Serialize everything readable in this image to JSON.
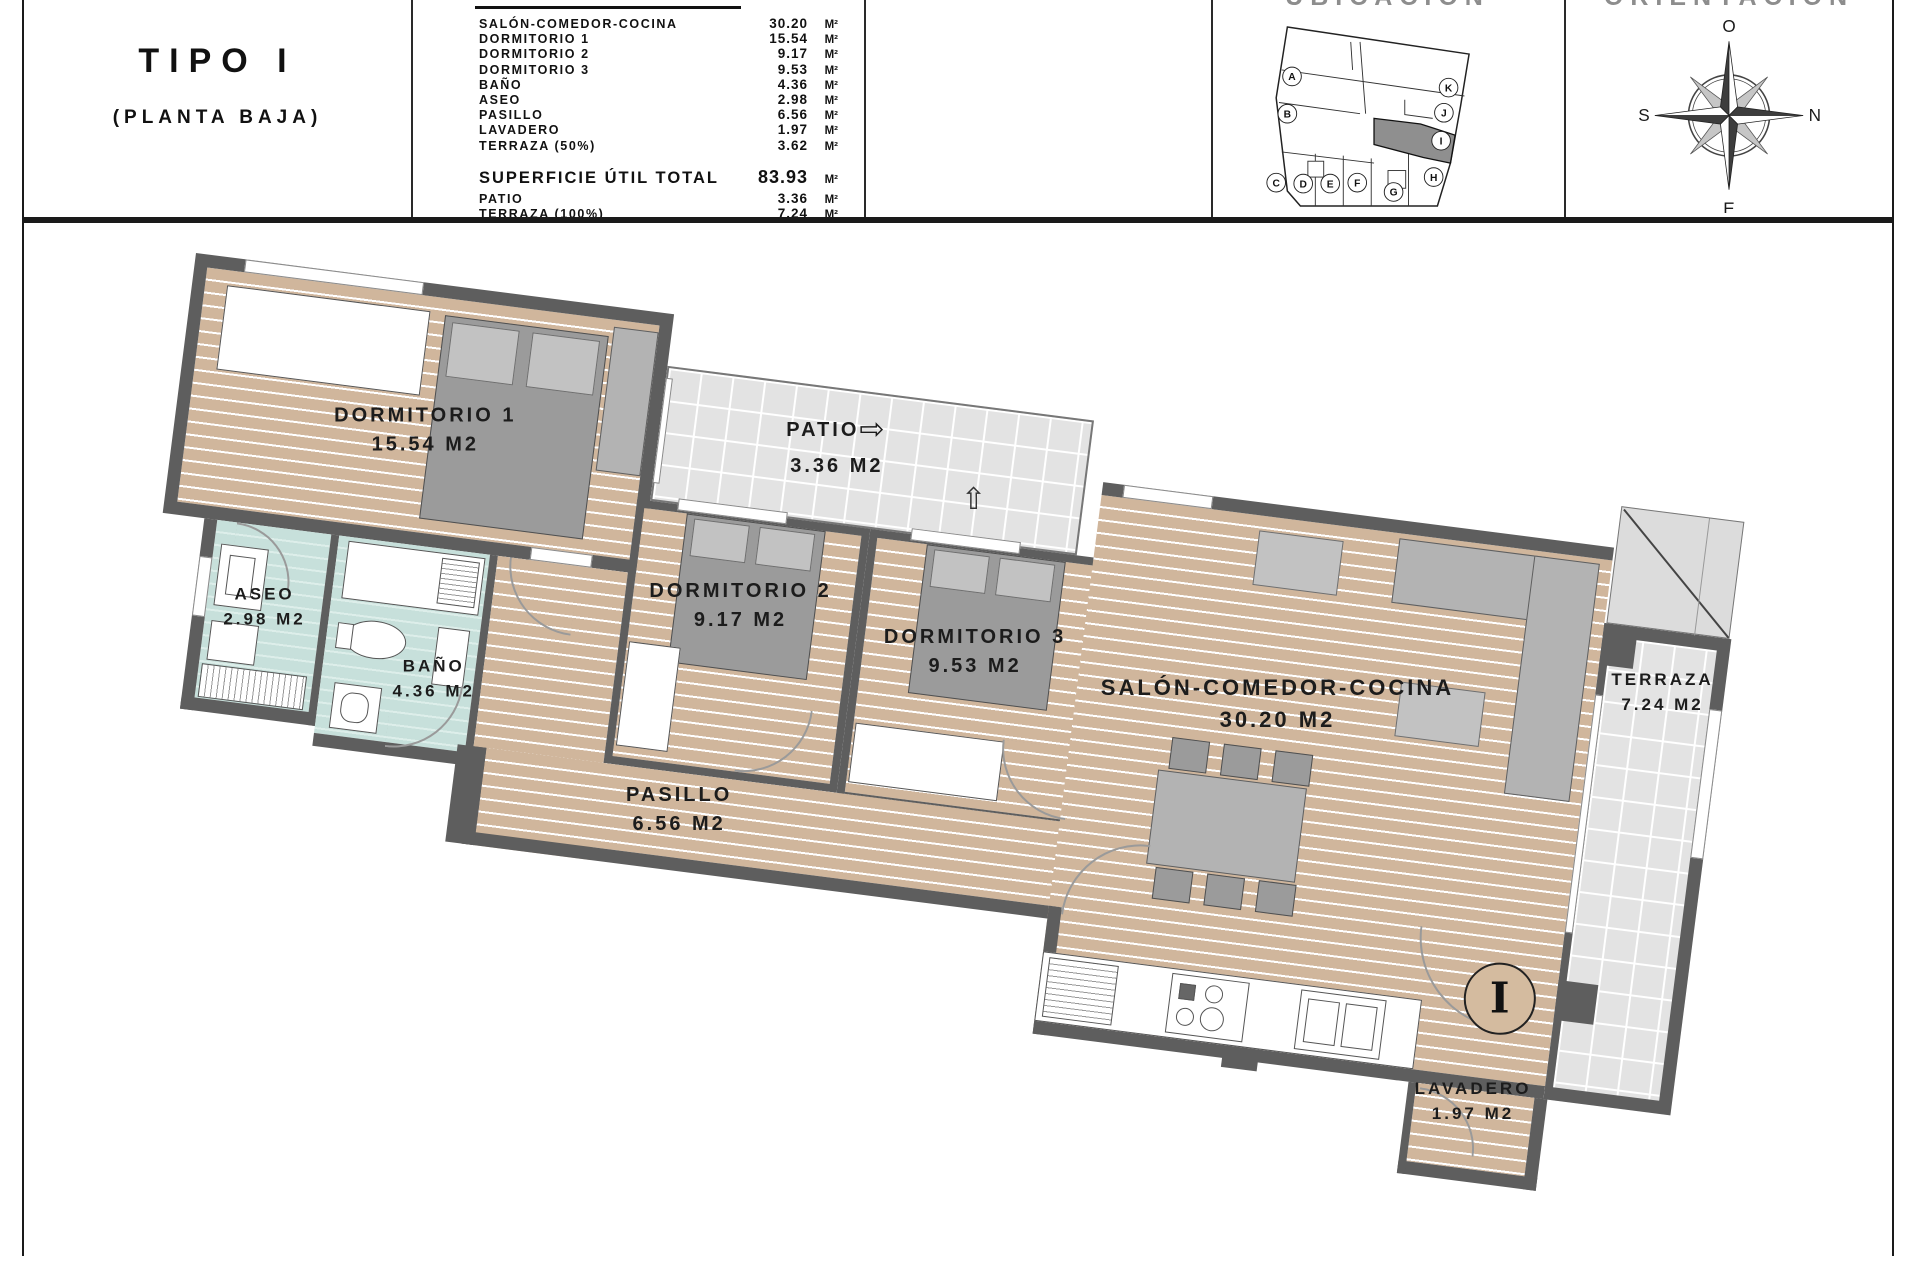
{
  "title_block": {
    "type_label": "TIPO I",
    "floor_label": "(PLANTA BAJA)"
  },
  "surface_table": {
    "unit": "M²",
    "rows": [
      {
        "label": "SALÓN-COMEDOR-COCINA",
        "value": "30.20"
      },
      {
        "label": "DORMITORIO 1",
        "value": "15.54"
      },
      {
        "label": "DORMITORIO 2",
        "value": "9.17"
      },
      {
        "label": "DORMITORIO 3",
        "value": "9.53"
      },
      {
        "label": "BAÑO",
        "value": "4.36"
      },
      {
        "label": "ASEO",
        "value": "2.98"
      },
      {
        "label": "PASILLO",
        "value": "6.56"
      },
      {
        "label": "LAVADERO",
        "value": "1.97"
      },
      {
        "label": "TERRAZA (50%)",
        "value": "3.62"
      }
    ],
    "total": {
      "label": "SUPERFICIE ÚTIL TOTAL",
      "value": "83.93"
    },
    "extra_rows": [
      {
        "label": "PATIO",
        "value": "3.36"
      },
      {
        "label": "TERRAZA (100%)",
        "value": "7.24"
      }
    ]
  },
  "location": {
    "header": "UBICACIÓN",
    "highlighted_unit": "I",
    "units": [
      "A",
      "B",
      "C",
      "D",
      "E",
      "F",
      "G",
      "H",
      "I",
      "J",
      "K"
    ]
  },
  "compass": {
    "header": "ORIENTACIÓN",
    "top": "O",
    "right": "N",
    "bottom": "E",
    "left": "S"
  },
  "plan": {
    "rooms": [
      {
        "name": "DORMITORIO 1",
        "area": "15.54 M2"
      },
      {
        "name": "PATIO",
        "area": "3.36 M2"
      },
      {
        "name": "ASEO",
        "area": "2.98 M2"
      },
      {
        "name": "BAÑO",
        "area": "4.36 M2"
      },
      {
        "name": "DORMITORIO 2",
        "area": "9.17 M2"
      },
      {
        "name": "DORMITORIO 3",
        "area": "9.53 M2"
      },
      {
        "name": "PASILLO",
        "area": "6.56 M2"
      },
      {
        "name": "SALÓN-COMEDOR-COCINA",
        "area": "30.20 M2"
      },
      {
        "name": "TERRAZA",
        "area": "7.24 M2"
      },
      {
        "name": "LAVADERO",
        "area": "1.97 M2"
      }
    ],
    "entrance_marker": "I",
    "patio_arrows": {
      "right": "⇨",
      "up": "⇧"
    },
    "colors": {
      "wall": "#5e5e5e",
      "wood": "#d0b69c",
      "bath": "#c7e0db",
      "tile": "#e3e3e3",
      "highlight": "#8f8f8f"
    }
  }
}
